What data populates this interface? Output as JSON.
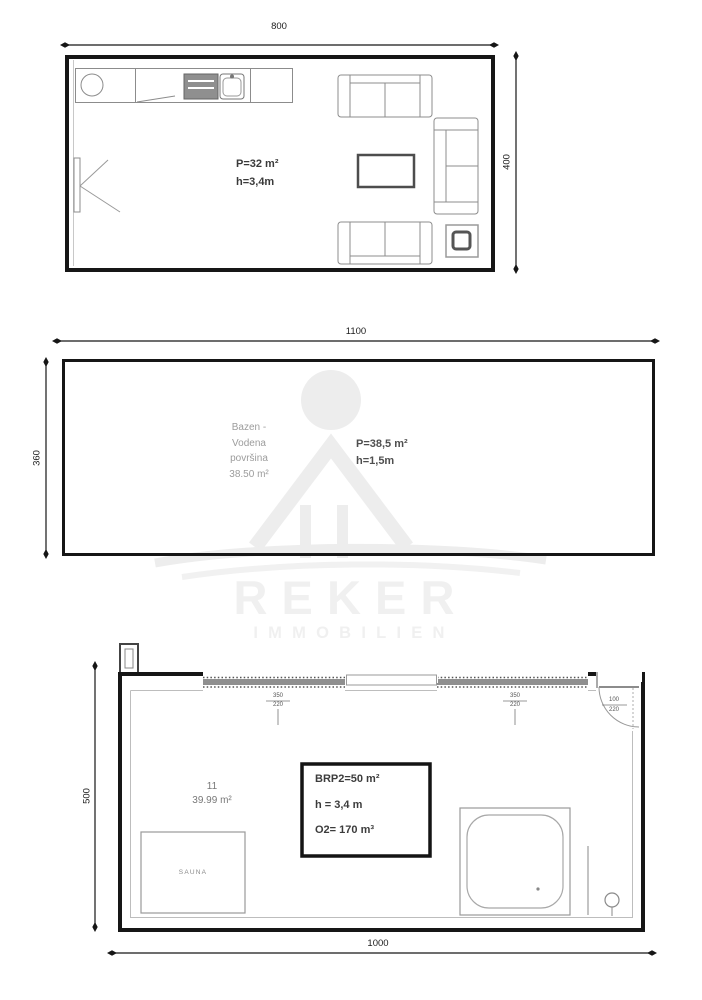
{
  "colors": {
    "wall_line": "#161616",
    "furniture_line": "#8c8c8c",
    "watermark": "#f0f0f0",
    "muted_text": "#9c9c9c"
  },
  "plan_top": {
    "width_dim": "800",
    "height_dim": "400",
    "info": {
      "area": "P=32 m²",
      "height": "h=3,4m"
    }
  },
  "plan_pool": {
    "width_dim": "1100",
    "height_dim": "360",
    "pool_label_lines": [
      "Bazen -",
      "Vodena",
      "površina",
      "38.50 m²"
    ],
    "info": {
      "area": "P=38,5 m²",
      "height": "h=1,5m"
    }
  },
  "watermark": {
    "name": "REKER",
    "subtitle": "IMMOBILIEN"
  },
  "plan_bottom": {
    "width_dim": "1000",
    "height_dim": "500",
    "room_number": "11",
    "room_area": "39.99 m²",
    "sauna_label": "SAUNA",
    "info_box": {
      "line1": "BRP2=50 m²",
      "line2": "h = 3,4 m",
      "line3": "O2= 170 m³"
    },
    "window1_dim": {
      "top": "350",
      "bottom": "220"
    },
    "window2_dim": {
      "top": "350",
      "bottom": "220"
    },
    "door_dim": {
      "top": "100",
      "bottom": "220"
    }
  }
}
